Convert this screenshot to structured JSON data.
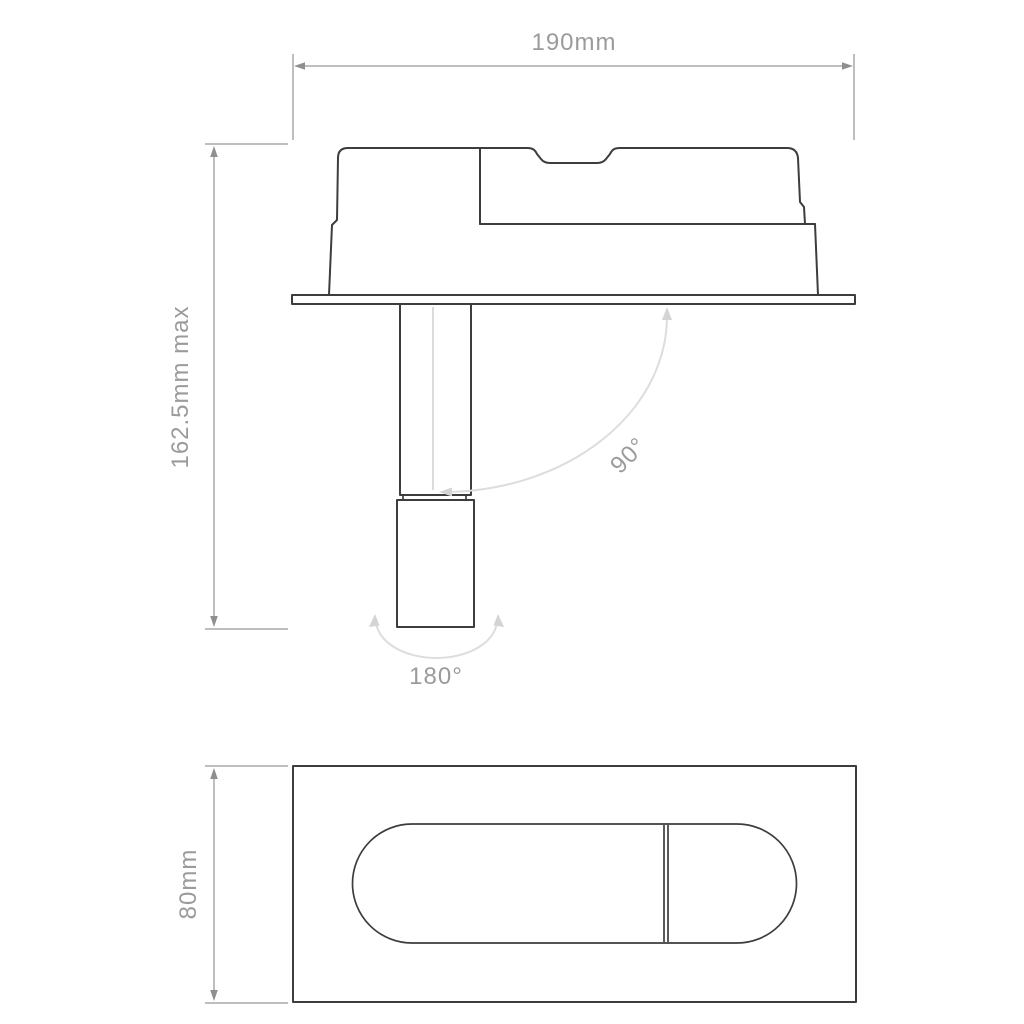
{
  "drawing": {
    "front_view": {
      "width_label": "190mm",
      "height_label": "162.5mm max",
      "tilt_label": "90°",
      "rotation_label": "180°"
    },
    "bottom_view": {
      "height_label": "80mm"
    }
  },
  "colors": {
    "outline": "#3d3d3d",
    "dimension_line": "#a9a9a9",
    "dimension_arrow": "#8f8f8f",
    "arc": "#dddddd",
    "arc_arrow": "#d4d4d4",
    "label_text": "#9b9b9b",
    "background": "#ffffff"
  }
}
